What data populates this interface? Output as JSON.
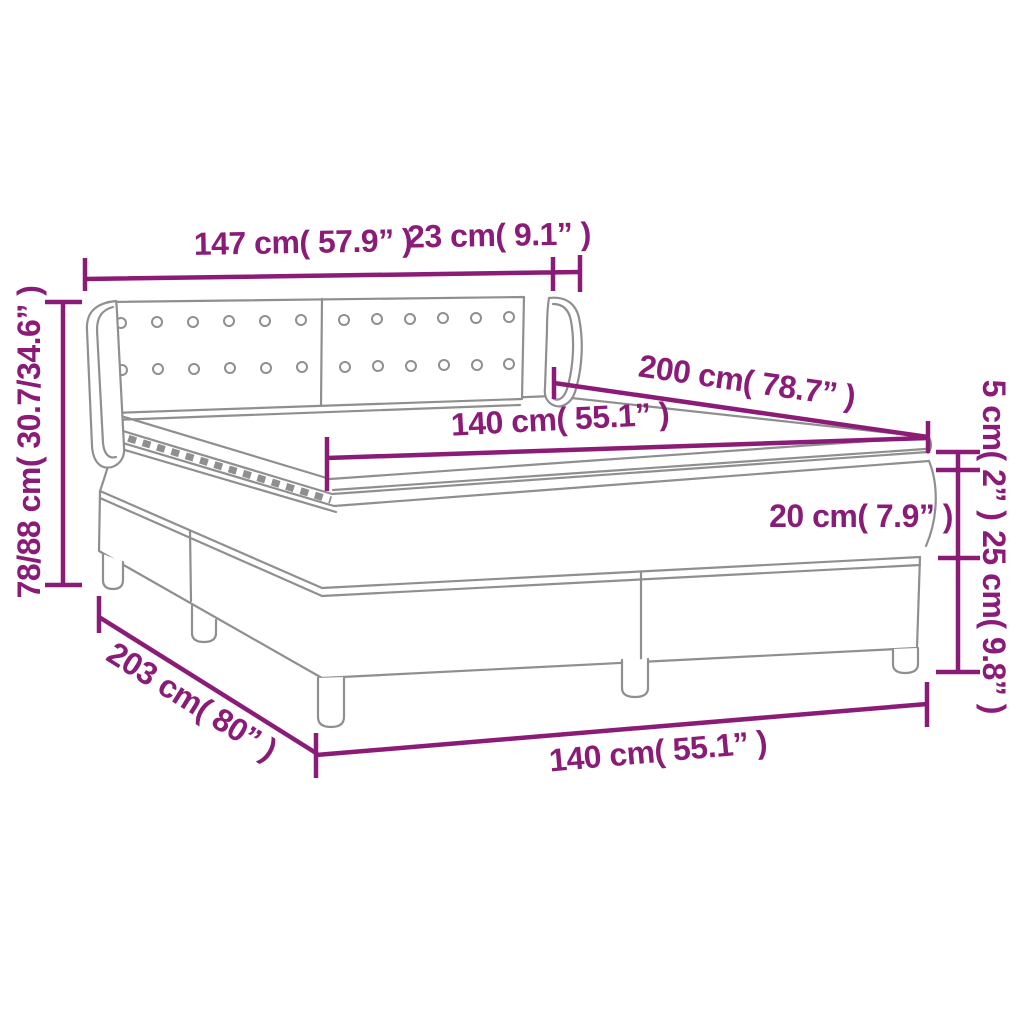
{
  "diagram": {
    "subject": "box-spring-bed-dimension-diagram",
    "colors": {
      "dimension_annotation": "#8a1c78",
      "line_art": "#8f8f8f",
      "background": "#ffffff"
    },
    "labels": {
      "headboard_width": "147 cm( 57.9” )",
      "wing_depth": "23 cm( 9.1” )",
      "total_height": "78/88 cm( 30.7/34.6” )",
      "bed_length": "200 cm( 78.7” )",
      "mattress_width_top": "140 cm( 55.1” )",
      "topper_height": "5 cm( 2” )",
      "mattress_height": "20 cm( 7.9” )",
      "base_height": "25 cm( 9.8” )",
      "base_length": "203 cm( 80” )",
      "mattress_width_bottom": "140 cm( 55.1” )"
    }
  }
}
